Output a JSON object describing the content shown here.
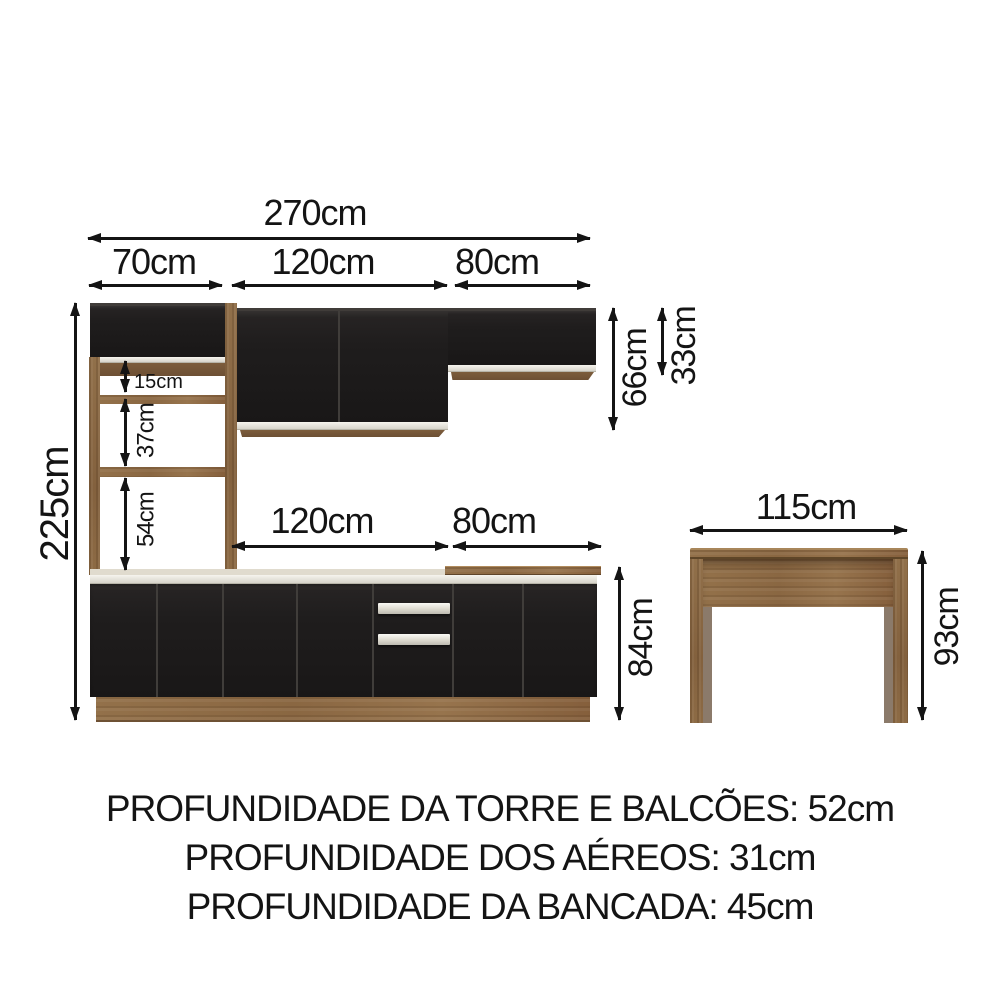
{
  "dimensions": {
    "overall_width": "270cm",
    "tower_width": "70cm",
    "upper_middle_width": "120cm",
    "upper_right_width": "80cm",
    "overall_height": "225cm",
    "niche_gap_top": "15cm",
    "niche_gap_middle": "37cm",
    "niche_gap_bottom": "54cm",
    "upper_tall_cabinet_height": "66cm",
    "upper_short_cabinet_height": "33cm",
    "base_middle_width": "120cm",
    "base_right_width": "80cm",
    "base_cabinet_height": "84cm",
    "desk_width": "115cm",
    "desk_height": "93cm"
  },
  "notes": [
    "PROFUNDIDADE DA TORRE E BALCÕES: 52cm",
    "PROFUNDIDADE DOS AÉREOS: 31cm",
    "PROFUNDIDADE DA BANCADA: 45cm"
  ],
  "colors": {
    "cabinet_door": "#1f1d1d",
    "wood": "#8d6b46",
    "trim": "#edeae2",
    "annotation": "#141414",
    "background": "#ffffff"
  }
}
